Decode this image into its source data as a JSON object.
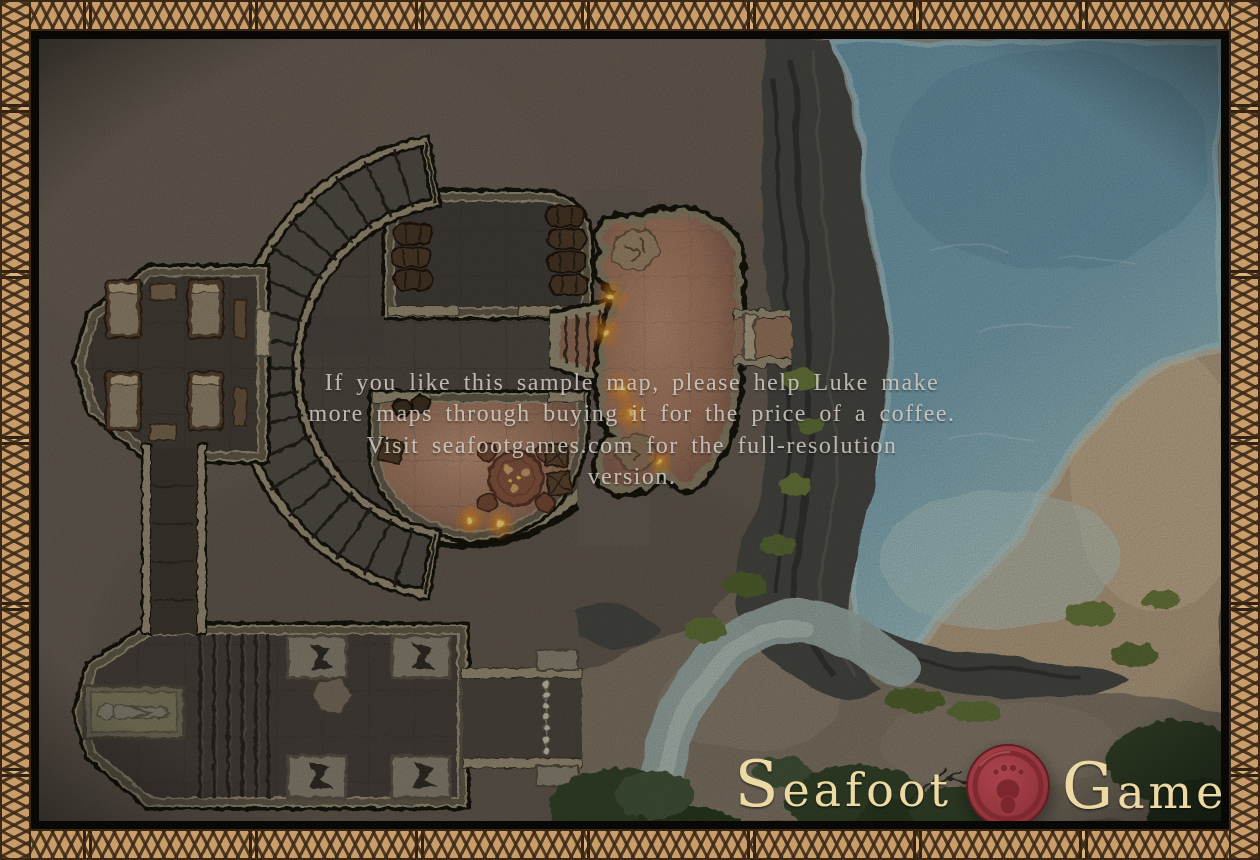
{
  "watermark": {
    "lines": [
      "If you like this sample map, please help Luke make",
      "more maps through buying it for the price of a coffee.",
      "Visit seafootgames.com for the full-resolution",
      "version."
    ]
  },
  "logo": {
    "word1": "Seafoot",
    "word2": "Games"
  },
  "colors": {
    "border_tan": "#c89d6a",
    "knotwork_brown": "#4a3420",
    "frame_black": "#0a0806",
    "ground": "#6b6156",
    "dungeon_floor": "#49433c",
    "stone_wall": "#9d9278",
    "warm_floor": "#a87c63",
    "torch_orange": "#f29018",
    "water_deep": "#6f9aad",
    "water_shallow": "#a7c6c6",
    "cliff_gray": "#4a4945",
    "sand": "#b7a183",
    "grass": "#64743a",
    "bush_green": "#36452a",
    "stream": "#9fb2ac",
    "watermark_text": "#d6d0c8",
    "logo_cream": "#ecd9a4",
    "seal_red": "#92333b"
  }
}
